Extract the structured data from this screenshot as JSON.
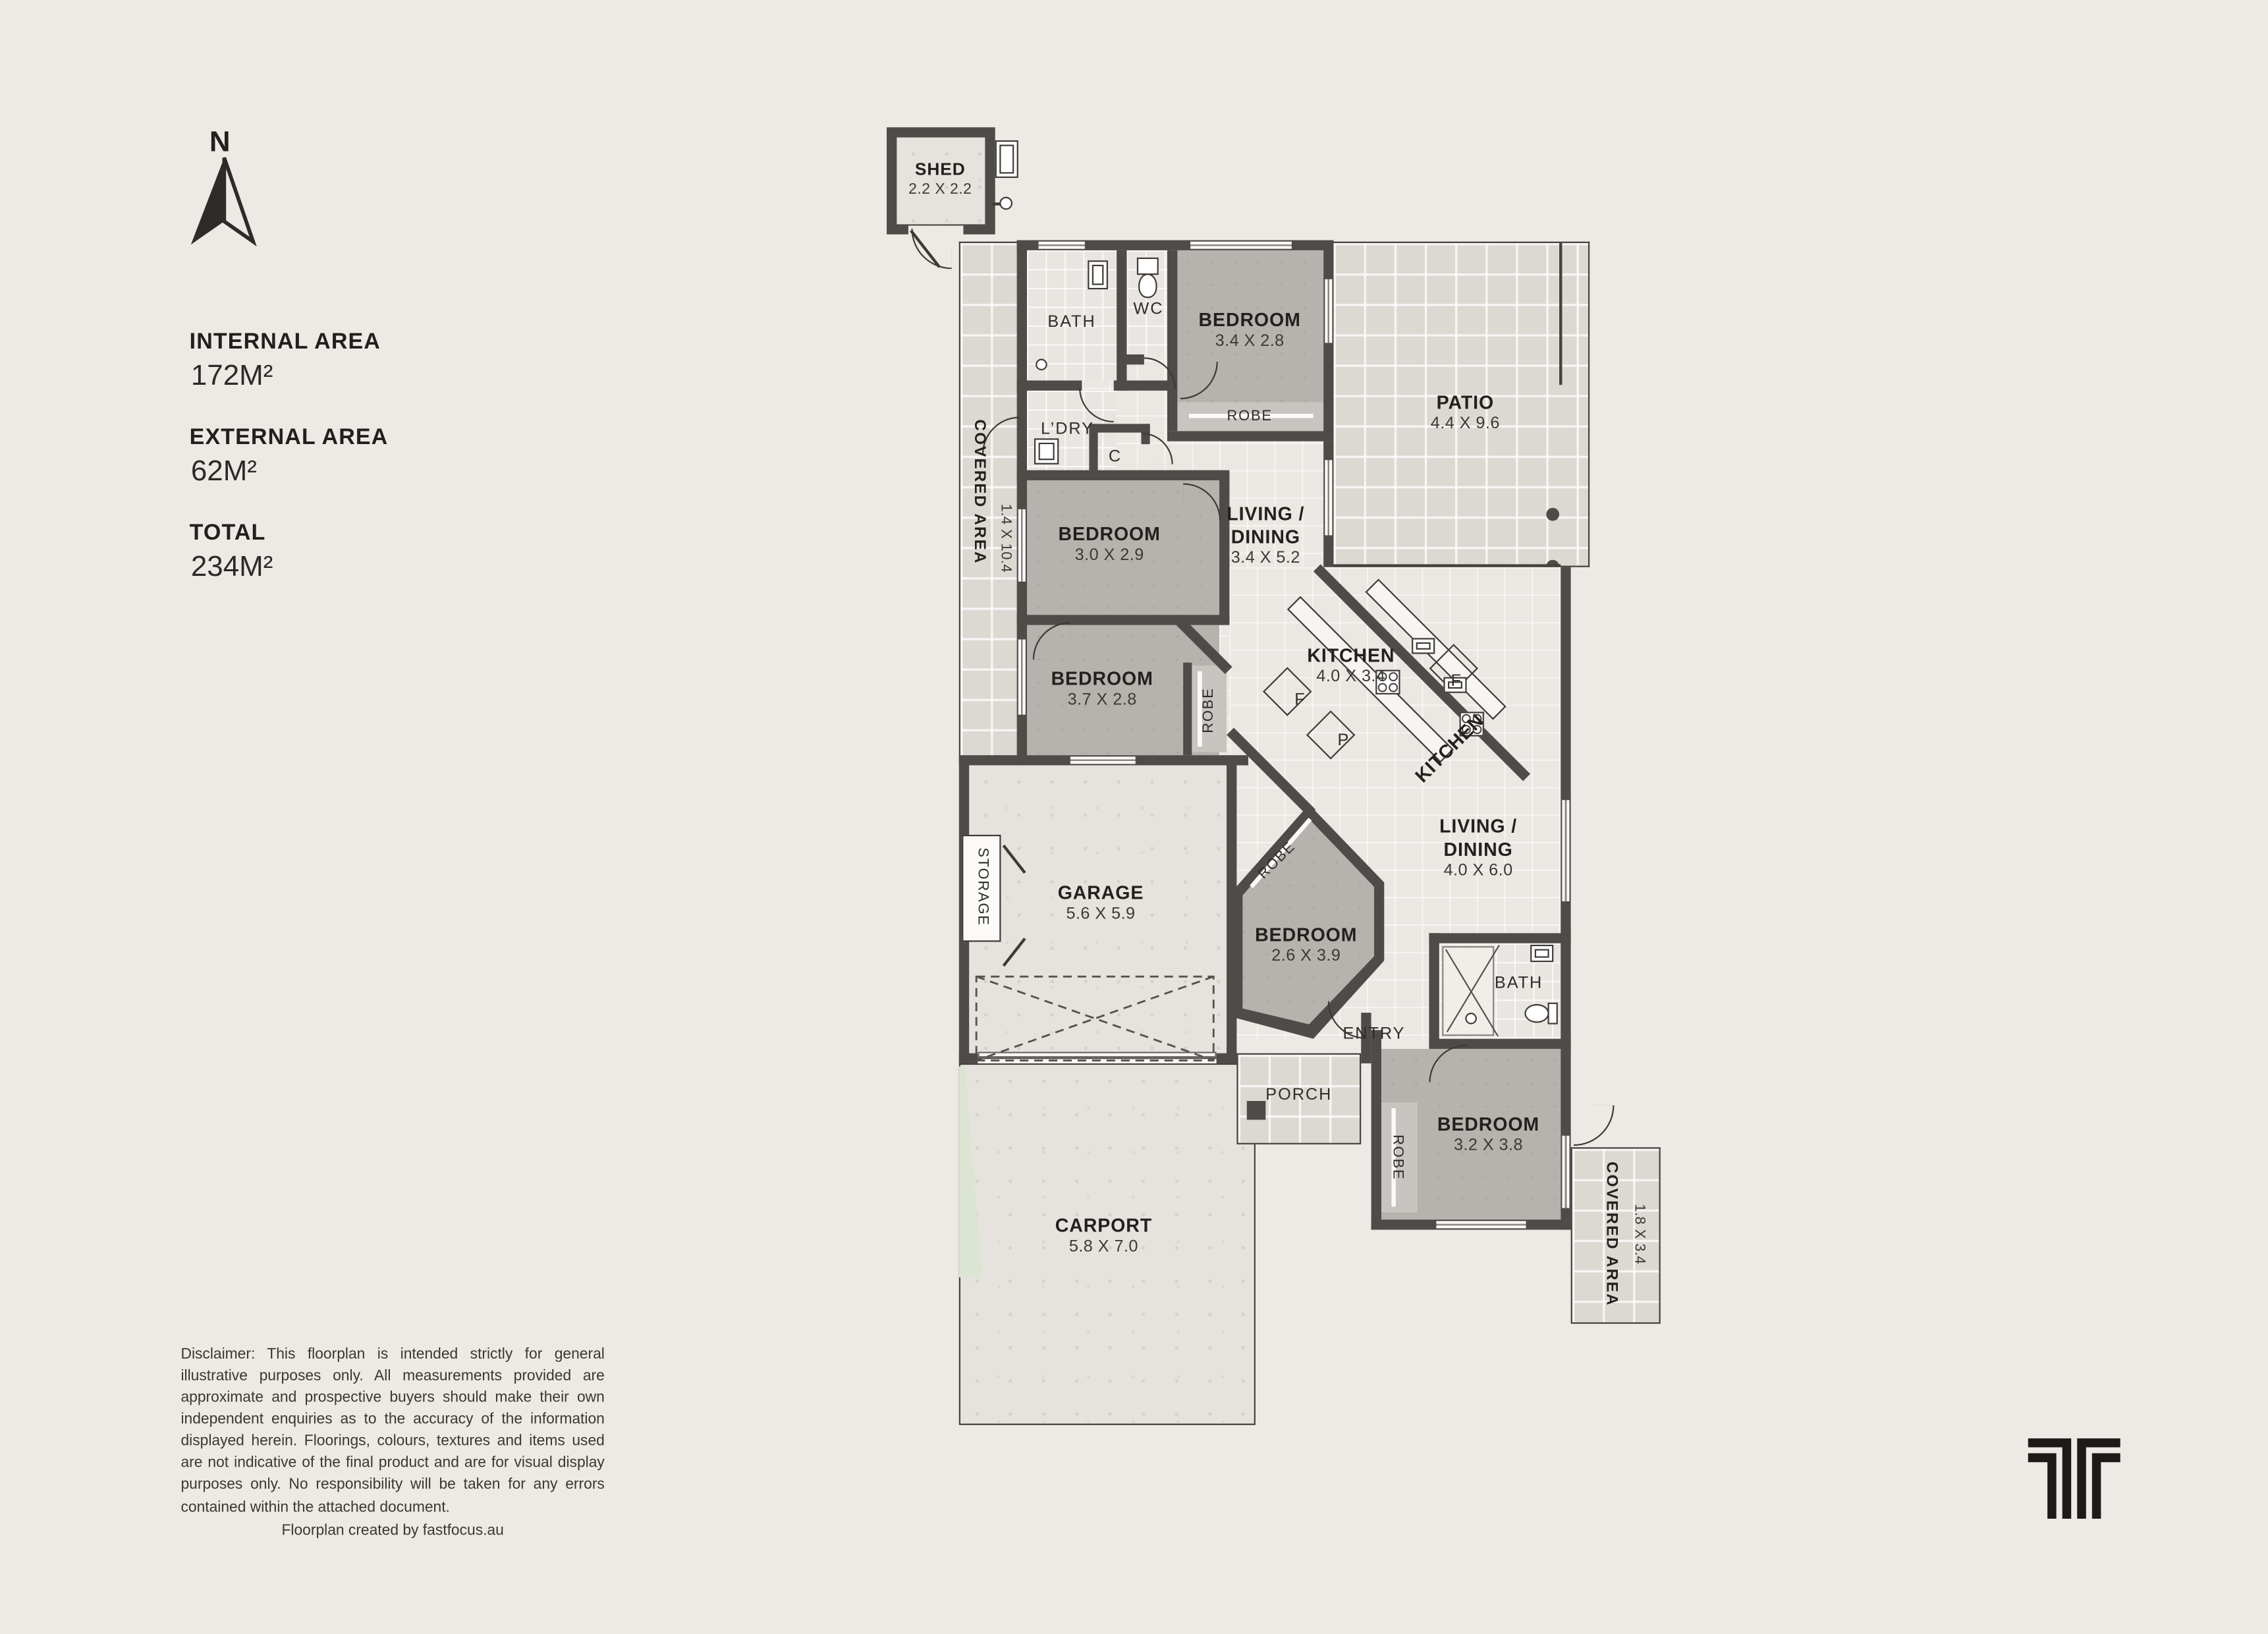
{
  "colors": {
    "wall": "#4f4b48",
    "bedroom_fill": "#b6b2ae",
    "background": "#edeae5",
    "tile": "#dcd8d2"
  },
  "compass": {
    "label": "N"
  },
  "stats": [
    {
      "label": "INTERNAL AREA",
      "value": "172M²"
    },
    {
      "label": "EXTERNAL AREA",
      "value": "62M²"
    },
    {
      "label": "TOTAL",
      "value": "234M²"
    }
  ],
  "rooms": {
    "shed": {
      "name": "SHED",
      "dims": "2.2 X 2.2"
    },
    "bath1": {
      "name": "BATH"
    },
    "wc": {
      "name": "WC"
    },
    "bed1": {
      "name": "BEDROOM",
      "dims": "3.4 X 2.8"
    },
    "robe1": {
      "name": "ROBE"
    },
    "patio": {
      "name": "PATIO",
      "dims": "4.4 X 9.6"
    },
    "covered1": {
      "name": "COVERED AREA",
      "dims": "1.4 X 10.4"
    },
    "ldry": {
      "name": "L’DRY"
    },
    "cupboard": {
      "name": "C"
    },
    "bed2": {
      "name": "BEDROOM",
      "dims": "3.0 X 2.9"
    },
    "living1": {
      "line1": "LIVING /",
      "line2": "DINING",
      "dims": "3.4 X 5.2"
    },
    "bed3": {
      "name": "BEDROOM",
      "dims": "3.7 X 2.8"
    },
    "robe2": {
      "name": "ROBE"
    },
    "kitchen1": {
      "name": "KITCHEN",
      "dims": "4.0 X 3.4"
    },
    "kitchen2": {
      "name": "KITCHEN"
    },
    "fridge_a": {
      "label": "F"
    },
    "fridge_b": {
      "label": "F"
    },
    "pantry": {
      "label": "P"
    },
    "living2": {
      "line1": "LIVING /",
      "line2": "DINING",
      "dims": "4.0 X 6.0"
    },
    "garage": {
      "name": "GARAGE",
      "dims": "5.6 X 5.9"
    },
    "storage": {
      "name": "STORAGE"
    },
    "bed4": {
      "name": "BEDROOM",
      "dims": "2.6 X 3.9"
    },
    "robe3": {
      "name": "ROBE"
    },
    "entry": {
      "name": "ENTRY"
    },
    "bath2": {
      "name": "BATH"
    },
    "bed5": {
      "name": "BEDROOM",
      "dims": "3.2 X 3.8"
    },
    "robe4": {
      "name": "ROBE"
    },
    "porch": {
      "name": "PORCH"
    },
    "carport": {
      "name": "CARPORT",
      "dims": "5.8 X 7.0"
    },
    "covered2": {
      "name": "COVERED AREA",
      "dims": "1.8 X 3.4"
    }
  },
  "footer": {
    "disclaimer": "Disclaimer: This floorplan is intended strictly for general illustrative purposes only. All measurements provided are approximate and prospective buyers should make their own independent enquiries as to the accuracy of the information displayed herein. Floorings, colours, textures and items used are not indicative of the final product and are for visual display purposes only. No responsibility will be taken for any errors contained within the attached document.",
    "credit": "Floorplan created by fastfocus.au"
  }
}
